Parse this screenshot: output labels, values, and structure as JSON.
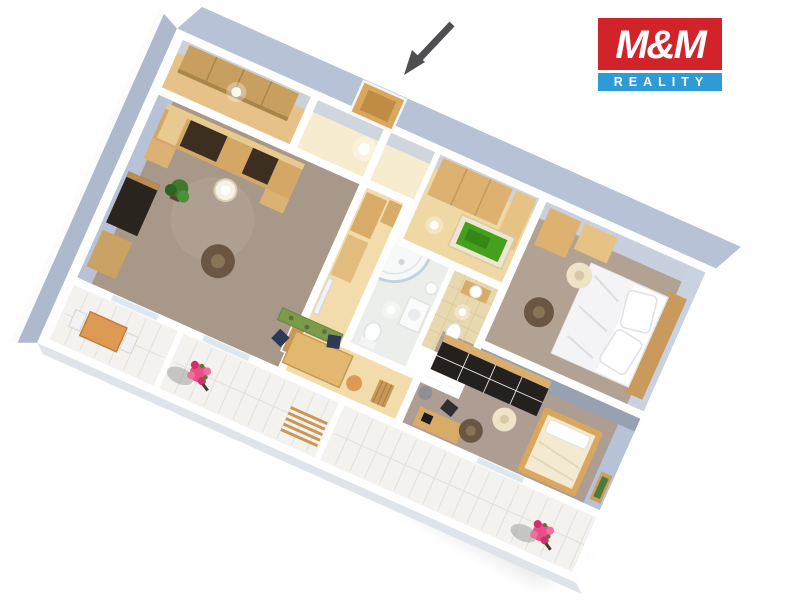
{
  "canvas": {
    "width": 800,
    "height": 600,
    "background": "#ffffff"
  },
  "logo": {
    "line1": "M&M",
    "line2": "REALITY",
    "red": "#d2232a",
    "blue": "#2e9bd6",
    "text_color": "#ffffff"
  },
  "annotation": {
    "entrance_arrow": {
      "shape": "arrow",
      "color": "#4f4f51",
      "direction": "down-left",
      "points_to": "entrance-door"
    }
  },
  "palette": {
    "wall_top": "#ffffff",
    "wall_face": "#b7c2d6",
    "wall_face_light": "#c9d2e0",
    "wall_face_dark": "#96a1b2",
    "wall_face_west": "#aeb9cd",
    "floor_wood": "#f2dcab",
    "floor_wood_light": "#f8ecce",
    "floor_closet": "#e6c288",
    "floor_nook": "#f0d8a4",
    "carpet_living": "#a79889",
    "carpet_bedroom1": "#b2a294",
    "carpet_bedroom2": "#ad9d92",
    "floor_bath": "#eceeec",
    "floor_tile_wc": "#e8d8b0",
    "floor_balcony": "#f3f2ef",
    "furniture_wood": "#d8ac68",
    "furniture_wood_light": "#e6c284",
    "furniture_dark": "#23201d",
    "bed_white": "#ffffff",
    "rug_green": "#7d9a4a",
    "rug_round_brown": "#6b5644",
    "pouf_cream": "#efe3c6",
    "chair_navy": "#2c3a57",
    "accent_orange": "#dd9a55",
    "flower_pink": "#e84f86",
    "flower_pink_dark": "#d22f6d",
    "plant_green": "#3e7a2e",
    "picture_green": "#44a01d",
    "shadow": "#d2d2d2"
  },
  "scene": {
    "view": "3d-isometric-floorplan",
    "rotation_deg": 24,
    "rooms": [
      {
        "name": "living-room",
        "floor": "brown-carpet",
        "items": [
          "wall-unit",
          "floor-lamp",
          "plant",
          "tv-desk",
          "sideboard",
          "round-rug",
          "door-leaf"
        ]
      },
      {
        "name": "entrance-hall",
        "floor": "light-wood",
        "items": [
          "entrance-door",
          "ceiling-light"
        ]
      },
      {
        "name": "closet-room",
        "floor": "wood",
        "items": [
          "shelf-unit"
        ]
      },
      {
        "name": "corridor",
        "floor": "wood",
        "items": [
          "wardrobe-cabinet",
          "cabinet",
          "mirror"
        ]
      },
      {
        "name": "dressing-nook",
        "floor": "wood",
        "items": [
          "wardrobe",
          "tall-cabinet",
          "green-picture"
        ]
      },
      {
        "name": "bathroom",
        "floor": "white",
        "items": [
          "corner-shower",
          "washer",
          "toilet",
          "sink"
        ]
      },
      {
        "name": "wc",
        "floor": "beige-tile",
        "items": [
          "sink-cabinet",
          "toilet"
        ]
      },
      {
        "name": "bedroom-double",
        "floor": "taupe-carpet",
        "items": [
          "double-bed",
          "pillows",
          "wardrobe-cabinets",
          "pouf",
          "round-rug"
        ]
      },
      {
        "name": "bedroom-single",
        "floor": "taupe-carpet",
        "items": [
          "black-sliding-wardrobe",
          "single-bed",
          "desk",
          "desk-chair",
          "pouf",
          "round-rug",
          "wall-picture"
        ]
      },
      {
        "name": "dining-area",
        "floor": "wood",
        "items": [
          "dining-table",
          "navy-chair",
          "navy-chair",
          "stool",
          "green-runner-rug",
          "high-chair"
        ]
      },
      {
        "name": "balcony-left",
        "floor": "white-tile",
        "items": [
          "cafe-table",
          "white-chair",
          "white-chair"
        ]
      },
      {
        "name": "balcony-middle",
        "floor": "white-tile",
        "items": [
          "flower-pot",
          "wood-slat-bench"
        ]
      },
      {
        "name": "balcony-right",
        "floor": "white-tile",
        "items": [
          "flower-pot"
        ]
      }
    ]
  }
}
